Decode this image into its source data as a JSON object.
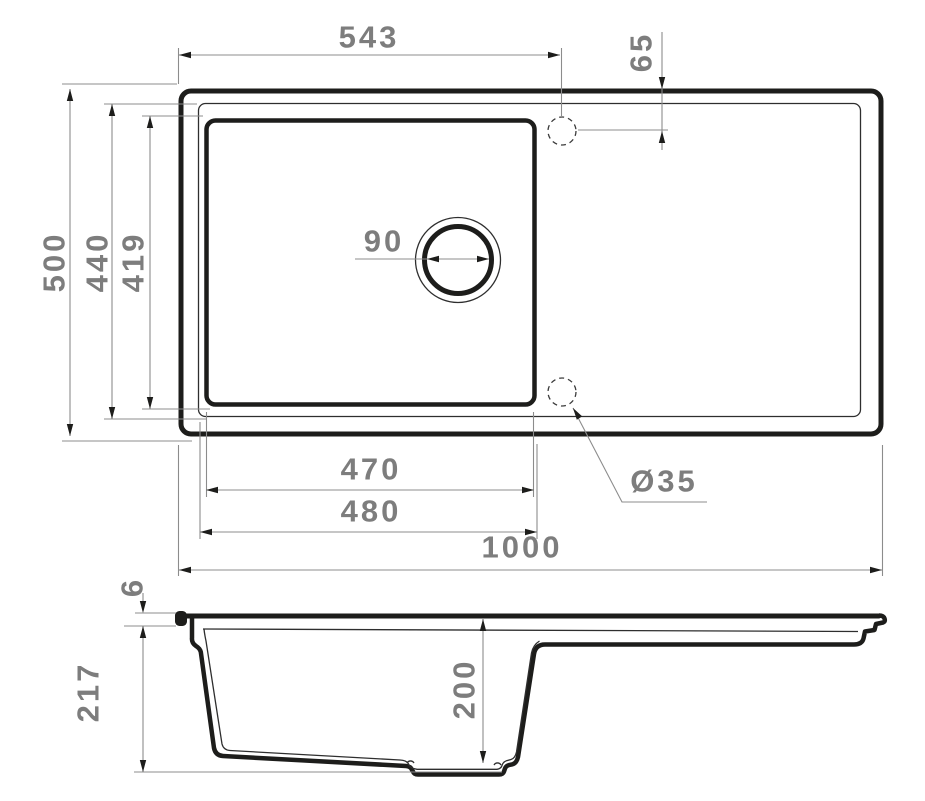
{
  "page": {
    "background": "#ffffff"
  },
  "drawing": {
    "description": "Kitchen sink installation drawing: plan (top) view with single bowl, drain hole and faucet hole positions, plus cross-section view below",
    "colors": {
      "outline": "#1d1d1b",
      "thin_line": "#2e2e2e",
      "dimension_line": "#8c8c8c",
      "dimension_text": "#7d7d7d"
    },
    "top_view": {
      "dims": {
        "faucet_offset_x": "543",
        "faucet_offset_y": "65",
        "overall_depth": "500",
        "bowl_cutout_depth": "440",
        "bowl_inner_depth": "419",
        "drain_diameter": "90",
        "bowl_inner_width": "470",
        "bowl_cutout_width": "480",
        "overall_length": "1000",
        "faucet_hole_diameter": "Ø35"
      }
    },
    "section_view": {
      "dims": {
        "rim_height": "6",
        "overall_height": "217",
        "bowl_depth": "200"
      }
    }
  }
}
